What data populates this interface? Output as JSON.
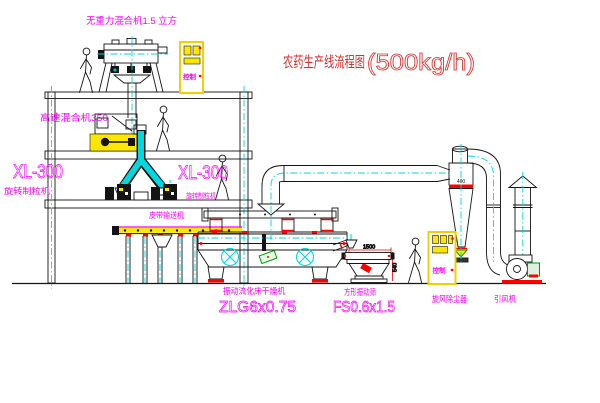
{
  "title": {
    "text": "农药生产线流程图",
    "capacity": "(500kg/h)"
  },
  "labels": {
    "gravity_mixer": "无重力混合机1.5 立方",
    "high_speed_mixer": "高速混合机350",
    "granulator_model": "XL-300",
    "granulator_name": "旋转制粒机",
    "belt_conveyor": "皮带输送机",
    "dryer_name": "振动流化床干燥机",
    "dryer_model": "ZLG6x0.75",
    "sieve_name": "方形振动筛",
    "sieve_model": "FS0.6x1.5",
    "cyclone_name": "旋风除尘器",
    "fan_name": "引风机"
  },
  "annotations": {
    "sieve_width_dim": "1500",
    "sieve_height_dim": "540",
    "cyclone_tag": "400",
    "cabinet_text": "控制"
  },
  "colors": {
    "background": "#ffffff",
    "line": "#141414",
    "centerline_cyan": "#00d8e0",
    "label_magenta": "#f400f4",
    "title_red": "#d43030",
    "accent_red": "#ff0000",
    "highlight_yellow": "#ffe600",
    "accent_green": "#009900"
  }
}
